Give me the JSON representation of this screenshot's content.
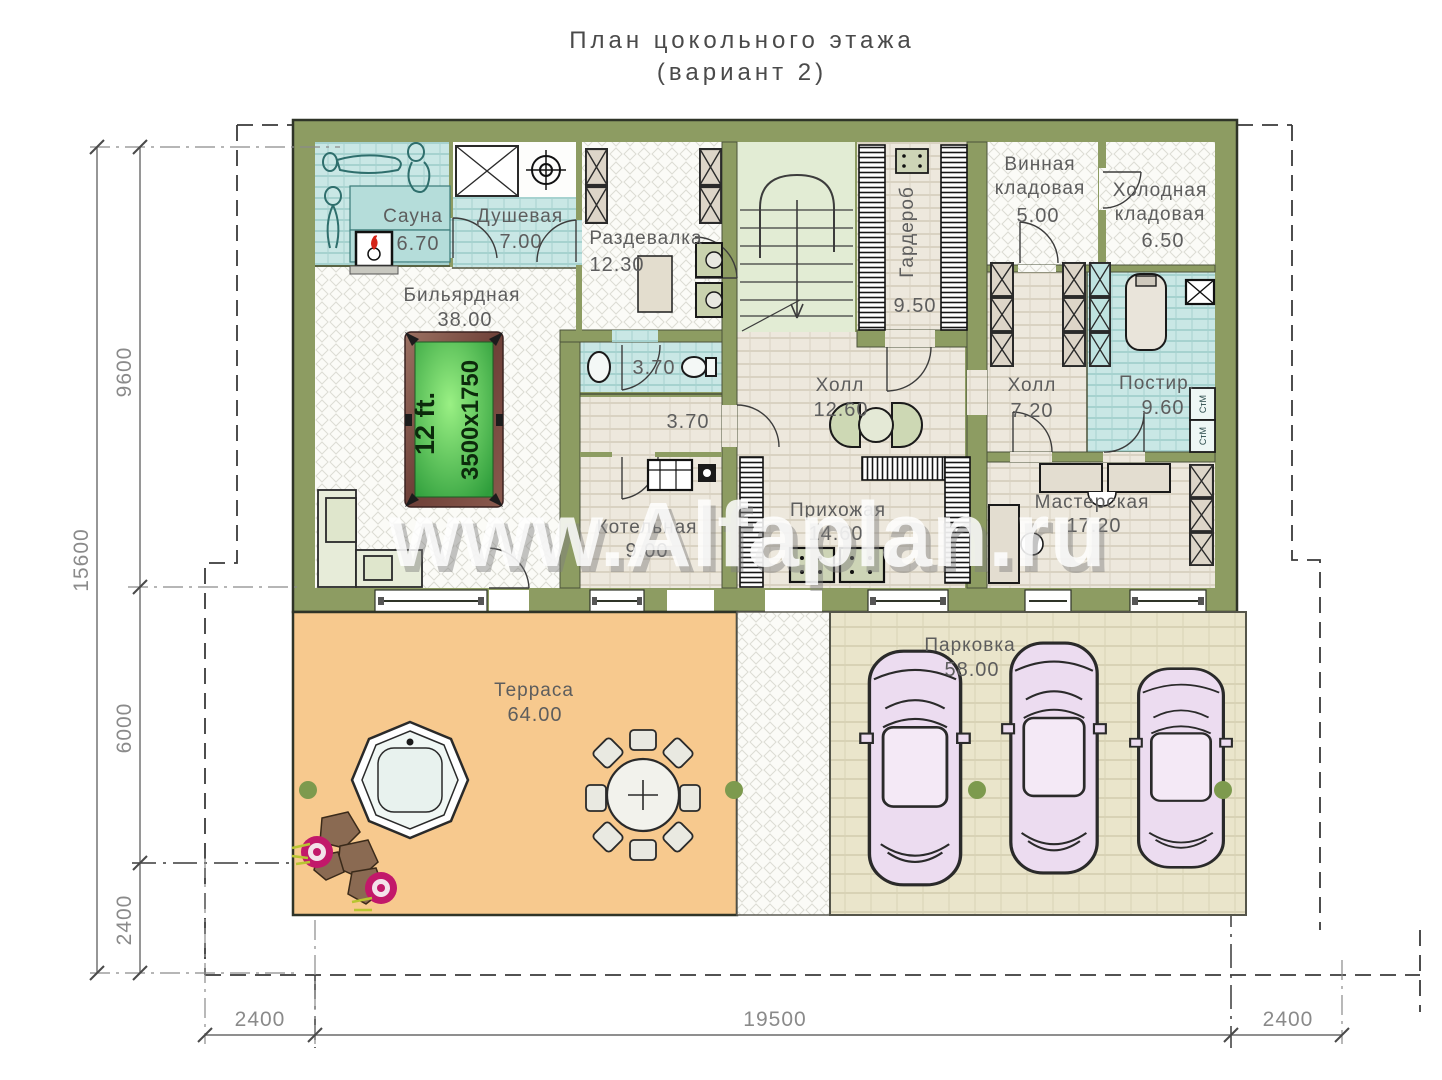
{
  "title": {
    "line1": "План цокольного этажа",
    "line2": "(вариант 2)"
  },
  "watermark": "www.Alfaplan.ru",
  "rooms": {
    "sauna": {
      "name": "Сауна",
      "area": "6.70"
    },
    "shower": {
      "name": "Душевая",
      "area": "7.00"
    },
    "dressing": {
      "name": "Раздевалка",
      "area": "12.30"
    },
    "billiard": {
      "name": "Бильярдная",
      "area": "38.00"
    },
    "wardrobe": {
      "name": "Гардероб",
      "area": "9.50"
    },
    "wine": {
      "name1": "Винная",
      "name2": "кладовая",
      "area": "5.00"
    },
    "cold": {
      "name1": "Холодная",
      "name2": "кладовая",
      "area": "6.50"
    },
    "hall_main": {
      "name": "Холл",
      "area": "12.60"
    },
    "hall_small": {
      "name": "Холл",
      "area": "7.20"
    },
    "laundry": {
      "name": "Постир.",
      "area": "9.60"
    },
    "wc": {
      "area": "3.70"
    },
    "corridor": {
      "area": "3.70"
    },
    "boiler": {
      "name": "Котельная",
      "area": "9.00"
    },
    "entry": {
      "name": "Прихожая",
      "area": "14.60"
    },
    "workshop": {
      "name": "Мастерская",
      "area": "17.20"
    },
    "terrace": {
      "name": "Терраса",
      "area": "64.00"
    },
    "parking": {
      "name": "Парковка",
      "area": "58.00"
    }
  },
  "billiard_table": {
    "size_label": "12 ft.",
    "dims_label": "3500x1750"
  },
  "appliances": {
    "washer1": "СтМ",
    "washer2": "СтМ"
  },
  "dimensions": {
    "left_total": "15600",
    "left_top": "9600",
    "left_mid": "6000",
    "left_bottom": "2400",
    "bottom_left": "2400",
    "bottom_center": "19500",
    "bottom_right": "2400"
  },
  "colors": {
    "wall": "#8d9c62",
    "teal": "#c9e7e5",
    "beige": "#ede8dd",
    "stairs": "#e2ecd4",
    "terrace": "#f7c98e",
    "parking": "#eae5cb",
    "billiard_green": "#3fae3f",
    "car": "#ecdcf0",
    "flower": "#c2186a",
    "rock": "#8a6a52",
    "column_dot": "#7d9a4e"
  }
}
